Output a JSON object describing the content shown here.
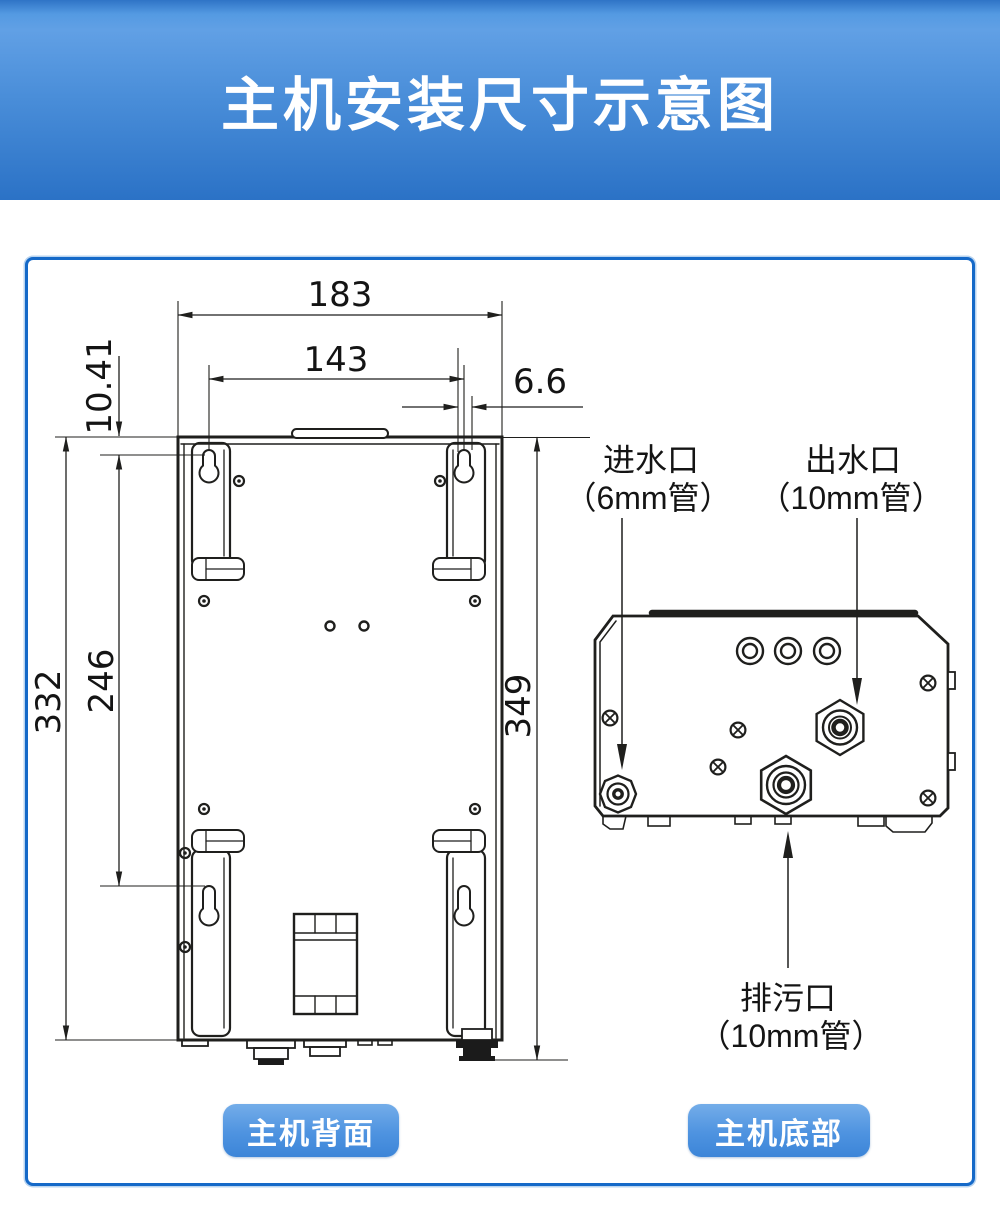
{
  "header": {
    "title": "主机安装尺寸示意图"
  },
  "rear_view": {
    "caption": "主机背面",
    "dimensions": {
      "overall_width": "183",
      "mounting_hole_spacing_width": "143",
      "keyhole_slot_width": "6.6",
      "hole_top_offset": "10.41",
      "body_height": "332",
      "mounting_hole_spacing_height": "246",
      "overall_height": "349"
    }
  },
  "bottom_view": {
    "caption": "主机底部",
    "ports": {
      "inlet": {
        "name": "进水口",
        "pipe": "（6mm管）"
      },
      "outlet": {
        "name": "出水口",
        "pipe": "（10mm管）"
      },
      "drain": {
        "name": "排污口",
        "pipe": "（10mm管）"
      }
    }
  },
  "colors": {
    "header_gradient_top": "#61a0e5",
    "header_gradient_bottom": "#2b72c6",
    "frame_border": "#1569c8",
    "badge_gradient_top": "#74ade9",
    "badge_gradient_bottom": "#3c85d8",
    "drawing_line": "#1f1f1d"
  }
}
